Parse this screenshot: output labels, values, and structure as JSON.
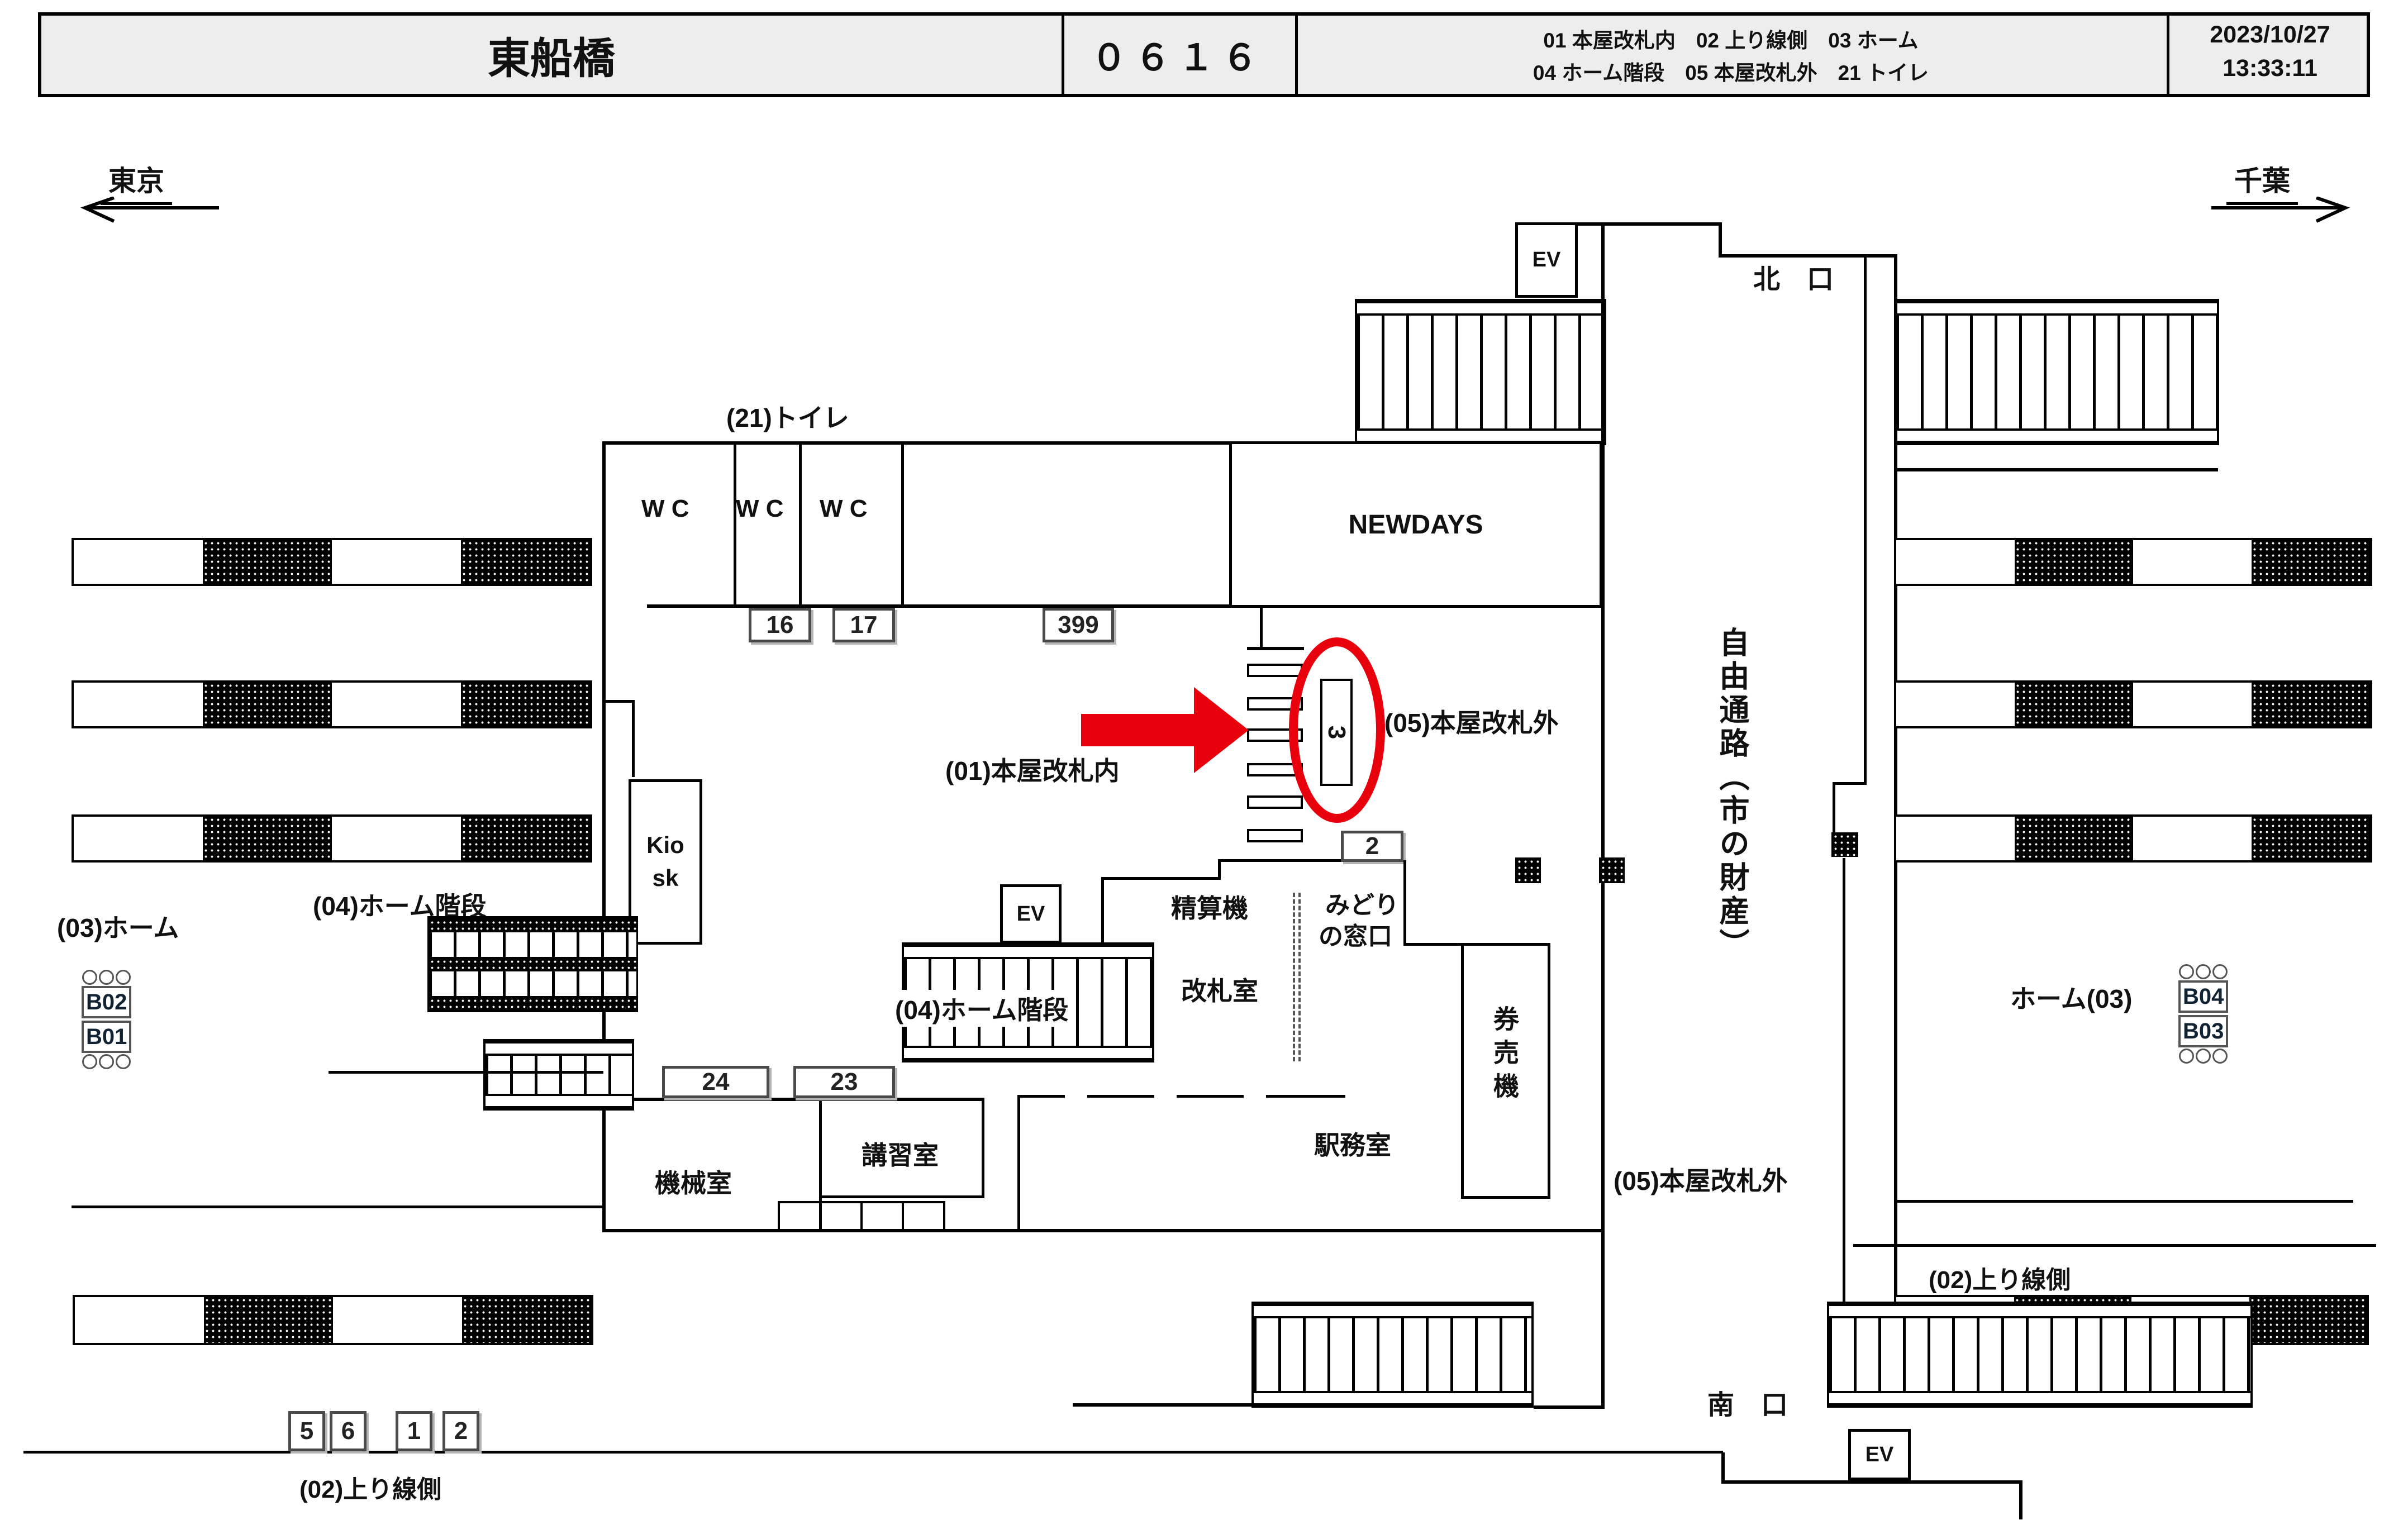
{
  "header": {
    "station": "東船橋",
    "station_code": "０６１６",
    "location_codes_line1": "01 本屋改札内　02 上り線側　03 ホーム",
    "location_codes_line2": "04 ホーム階段　05 本屋改札外　21 トイレ",
    "date": "2023/10/27",
    "time": "13:33:11"
  },
  "directions": {
    "to_west": "東京",
    "to_east": "千葉"
  },
  "exits": {
    "north": "北　口",
    "south": "南　口"
  },
  "areas": {
    "toilet_label": "(21)トイレ",
    "wc": "W C",
    "newdays": "NEWDAYS",
    "kiosk_line1": "Kio",
    "kiosk_line2": "sk",
    "inside_gates": "(01)本屋改札内",
    "outside_gates_upper": "(05)本屋改札外",
    "outside_gates_lower": "(05)本屋改札外",
    "platform_stairs_west": "(04)ホーム階段",
    "platform_stairs_center": "(04)ホーム階段",
    "fare_adjustment": "精算機",
    "gate_office": "改札室",
    "midori_line1": "みどり",
    "midori_line2": "の窓口",
    "ticket_machines": "券売機",
    "station_office": "駅務室",
    "machine_room": "機械室",
    "training_room": "講習室",
    "platform_label_west": "(03)ホーム",
    "platform_label_east": "ホーム(03)",
    "up_line_west": "(02)上り線側",
    "up_line_east": "(02)上り線側",
    "free_passage": "自由通路（市の財産）",
    "elevator": "EV"
  },
  "camera_boxes": {
    "b16": "16",
    "b17": "17",
    "b399": "399",
    "b2_midori": "2",
    "b24": "24",
    "b23": "23",
    "b5": "5",
    "b6": "6",
    "b1": "1",
    "b2_track": "2",
    "circled_gate": "3"
  },
  "signs": {
    "b02": "B02",
    "b01": "B01",
    "b04": "B04",
    "b03": "B03"
  },
  "colors": {
    "highlight": "#e8000d",
    "header_bg": "#ededed",
    "line": "#000000"
  }
}
